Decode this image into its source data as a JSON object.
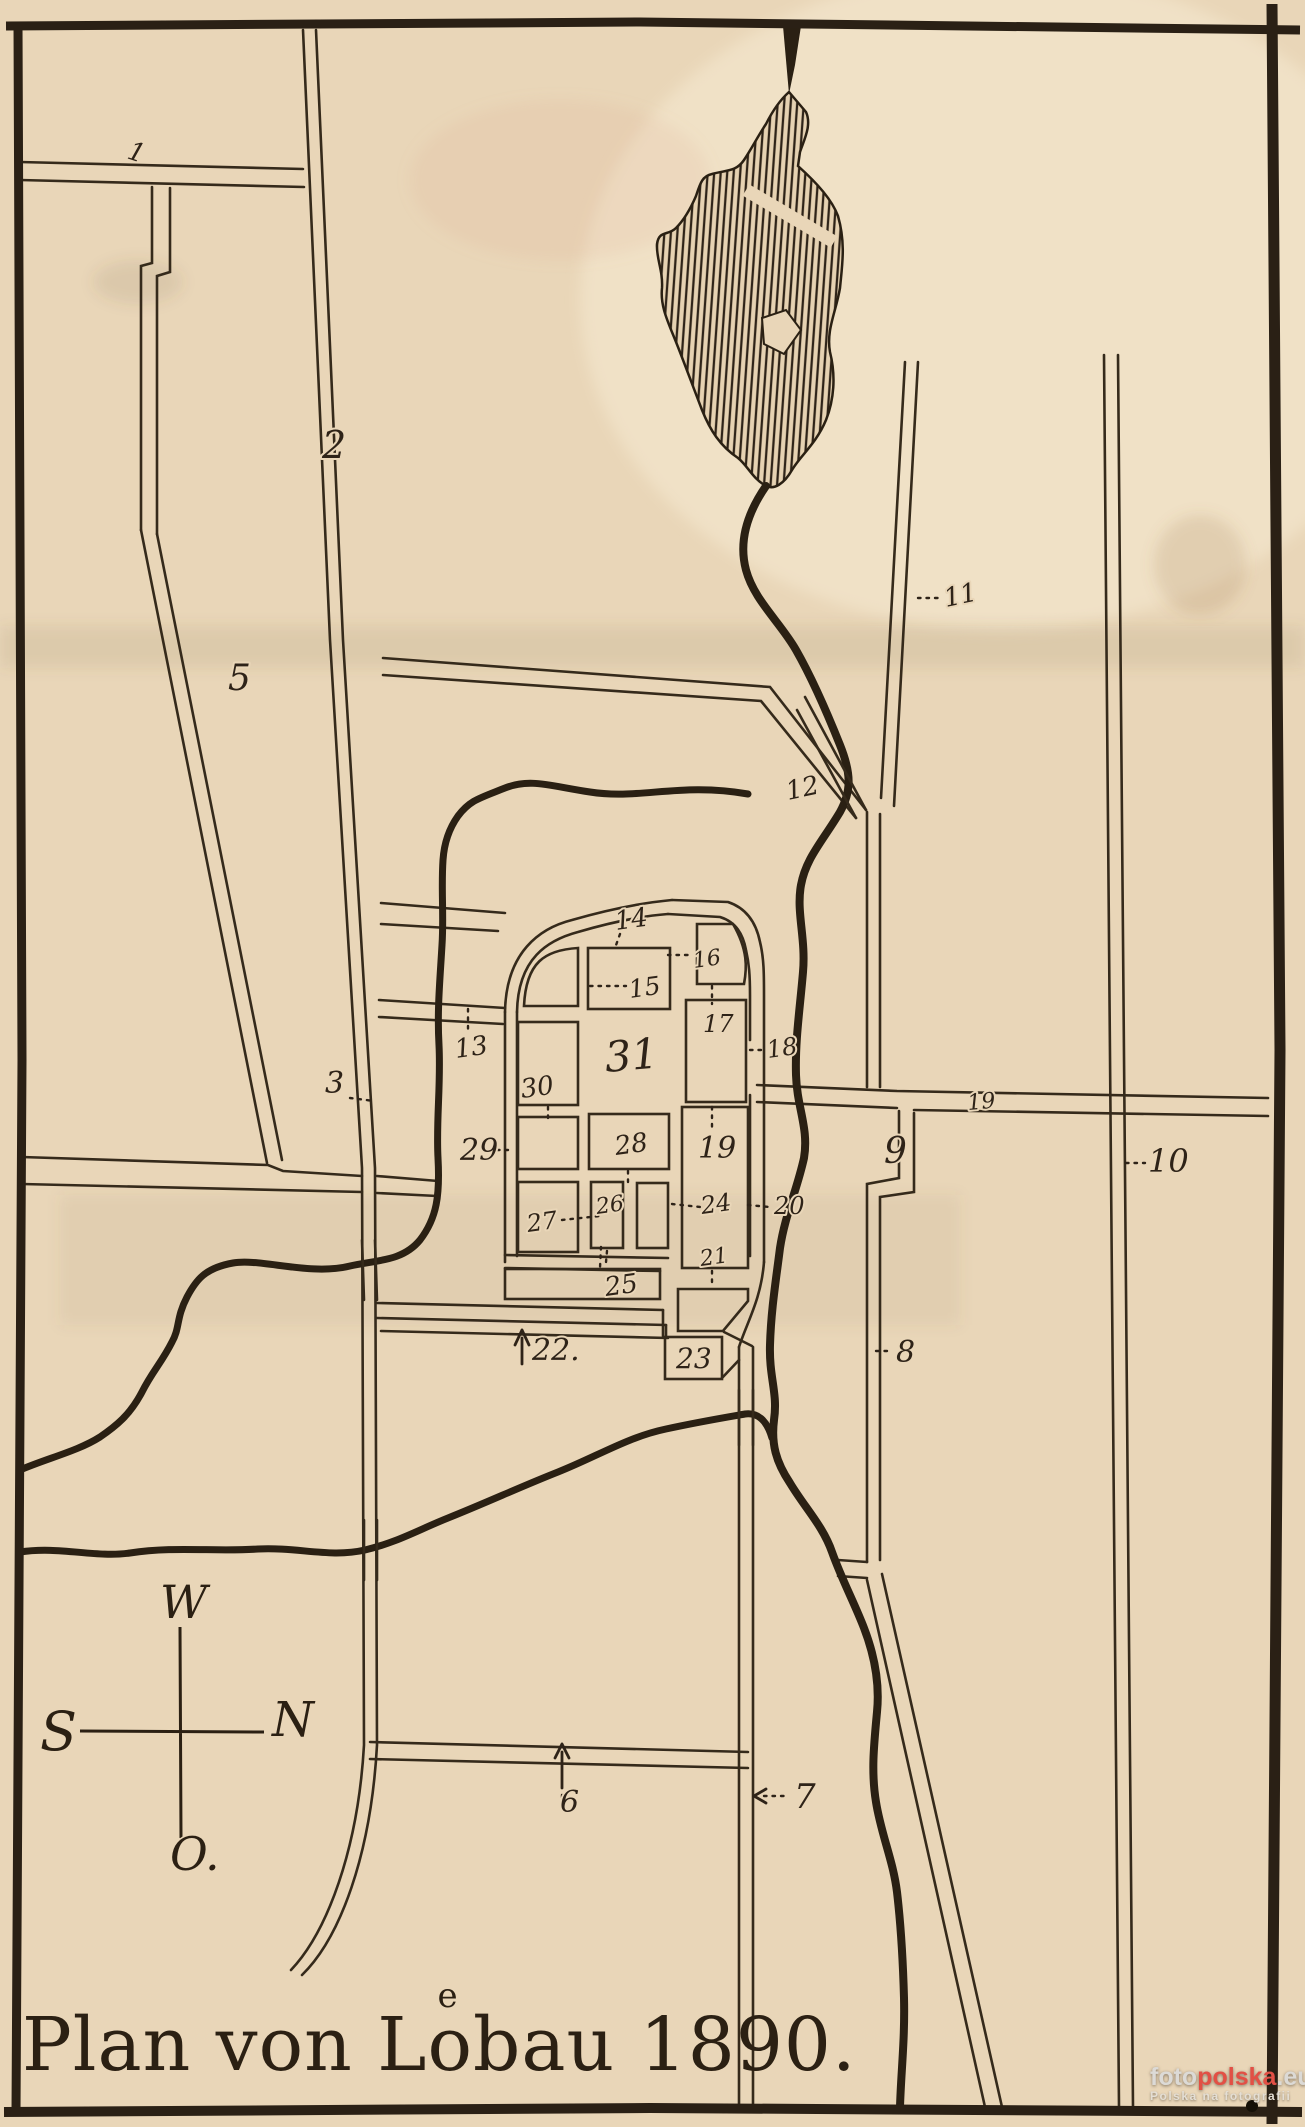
{
  "title": {
    "full": "Plan von Löbau 1890.",
    "prefix": "Plan von L",
    "o_super": "e",
    "o_base": "o",
    "suffix": "bau 1890."
  },
  "compass": {
    "top": "W",
    "left": "S",
    "right": "N",
    "bottom": "O."
  },
  "colors": {
    "paper": "#e9d6b8",
    "ink": "#2e2318",
    "water": "#2a2013",
    "watermark_red": "#e25045",
    "watermark_gray": "#dcdad6"
  },
  "watermark": {
    "part1": "foto",
    "part2": "polska",
    "part3": ".eu",
    "line2": "Polska na fotografii"
  },
  "labels": [
    {
      "text": "1",
      "x": 126,
      "y": 158,
      "size": 26,
      "rot": 18
    },
    {
      "text": "2",
      "x": 322,
      "y": 458,
      "size": 38,
      "rot": 0
    },
    {
      "text": "3",
      "x": 325,
      "y": 1093,
      "size": 30,
      "rot": 0
    },
    {
      "text": "5",
      "x": 228,
      "y": 690,
      "size": 36,
      "rot": 0
    },
    {
      "text": "6",
      "x": 560,
      "y": 1812,
      "size": 30,
      "rot": 0
    },
    {
      "text": "7",
      "x": 794,
      "y": 1808,
      "size": 34,
      "rot": 0
    },
    {
      "text": "8",
      "x": 896,
      "y": 1362,
      "size": 30,
      "rot": 0
    },
    {
      "text": "9",
      "x": 884,
      "y": 1163,
      "size": 36,
      "rot": 0
    },
    {
      "text": "10",
      "x": 1148,
      "y": 1172,
      "size": 32,
      "rot": 0
    },
    {
      "text": "11",
      "x": 946,
      "y": 607,
      "size": 26,
      "rot": -12
    },
    {
      "text": "12",
      "x": 788,
      "y": 800,
      "size": 26,
      "rot": -12
    },
    {
      "text": "13",
      "x": 456,
      "y": 1058,
      "size": 26,
      "rot": -8
    },
    {
      "text": "14",
      "x": 616,
      "y": 930,
      "size": 26,
      "rot": -8
    },
    {
      "text": "15",
      "x": 630,
      "y": 998,
      "size": 25,
      "rot": -8
    },
    {
      "text": "16",
      "x": 694,
      "y": 968,
      "size": 22,
      "rot": -8
    },
    {
      "text": "17",
      "x": 703,
      "y": 1032,
      "size": 24,
      "rot": 0
    },
    {
      "text": "18",
      "x": 768,
      "y": 1058,
      "size": 24,
      "rot": -8
    },
    {
      "text": "31",
      "x": 606,
      "y": 1072,
      "size": 42,
      "rot": -5
    },
    {
      "text": "19",
      "x": 698,
      "y": 1158,
      "size": 30,
      "rot": 0
    },
    {
      "text": "19",
      "x": 968,
      "y": 1110,
      "size": 22,
      "rot": -5
    },
    {
      "text": "20",
      "x": 774,
      "y": 1214,
      "size": 24,
      "rot": 0
    },
    {
      "text": "21",
      "x": 701,
      "y": 1266,
      "size": 22,
      "rot": -8
    },
    {
      "text": "22.",
      "x": 532,
      "y": 1360,
      "size": 30,
      "rot": 0
    },
    {
      "text": "23",
      "x": 676,
      "y": 1368,
      "size": 28,
      "rot": 0
    },
    {
      "text": "24",
      "x": 702,
      "y": 1214,
      "size": 24,
      "rot": -8
    },
    {
      "text": "25",
      "x": 606,
      "y": 1296,
      "size": 26,
      "rot": -8
    },
    {
      "text": "26",
      "x": 597,
      "y": 1214,
      "size": 22,
      "rot": -8
    },
    {
      "text": "27",
      "x": 528,
      "y": 1232,
      "size": 24,
      "rot": -8
    },
    {
      "text": "28",
      "x": 616,
      "y": 1155,
      "size": 26,
      "rot": -8
    },
    {
      "text": "29",
      "x": 460,
      "y": 1160,
      "size": 30,
      "rot": 0
    },
    {
      "text": "30",
      "x": 522,
      "y": 1098,
      "size": 26,
      "rot": -8
    },
    {
      "text": "13b",
      "x": 0,
      "y": 0,
      "size": 0,
      "rot": 0,
      "hidden": true
    }
  ]
}
